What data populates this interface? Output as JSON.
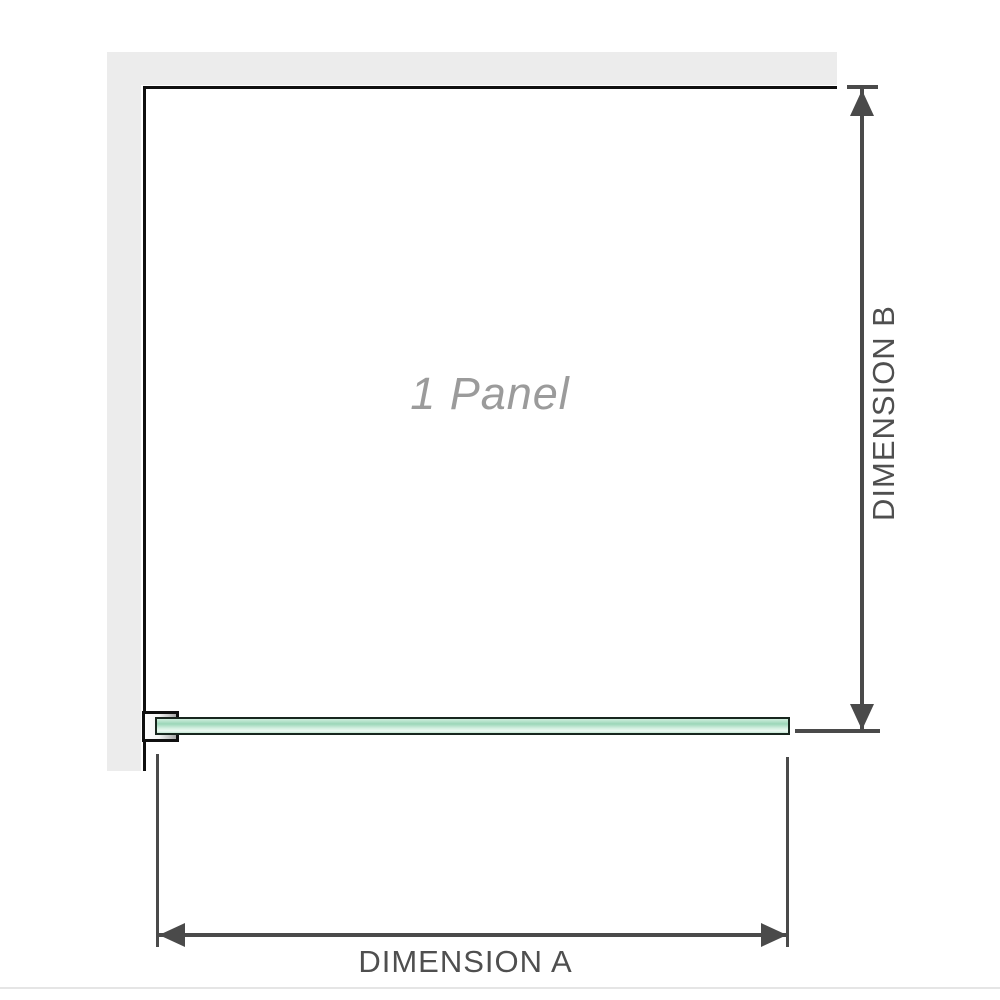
{
  "diagram": {
    "panel_label": "1 Panel",
    "dimension_a": {
      "label": "DIMENSION A"
    },
    "dimension_b": {
      "label": "DIMENSION B"
    }
  },
  "icons": {
    "dim_b_top": "arrow-up-icon",
    "dim_b_bottom": "arrow-down-icon",
    "dim_a_left": "arrow-left-icon",
    "dim_a_right": "arrow-right-icon"
  },
  "colors": {
    "wall_fill": "#ececec",
    "frame_line": "#101010",
    "dimension_line": "#4a4a4a",
    "dimension_text": "#4f4f4f",
    "watermark_text": "#9b9b9b",
    "glass_green_light": "#ecf9f2",
    "glass_green_mid": "#9bd6b8",
    "glass_border": "#18261e",
    "divider": "#e5e5e5"
  }
}
